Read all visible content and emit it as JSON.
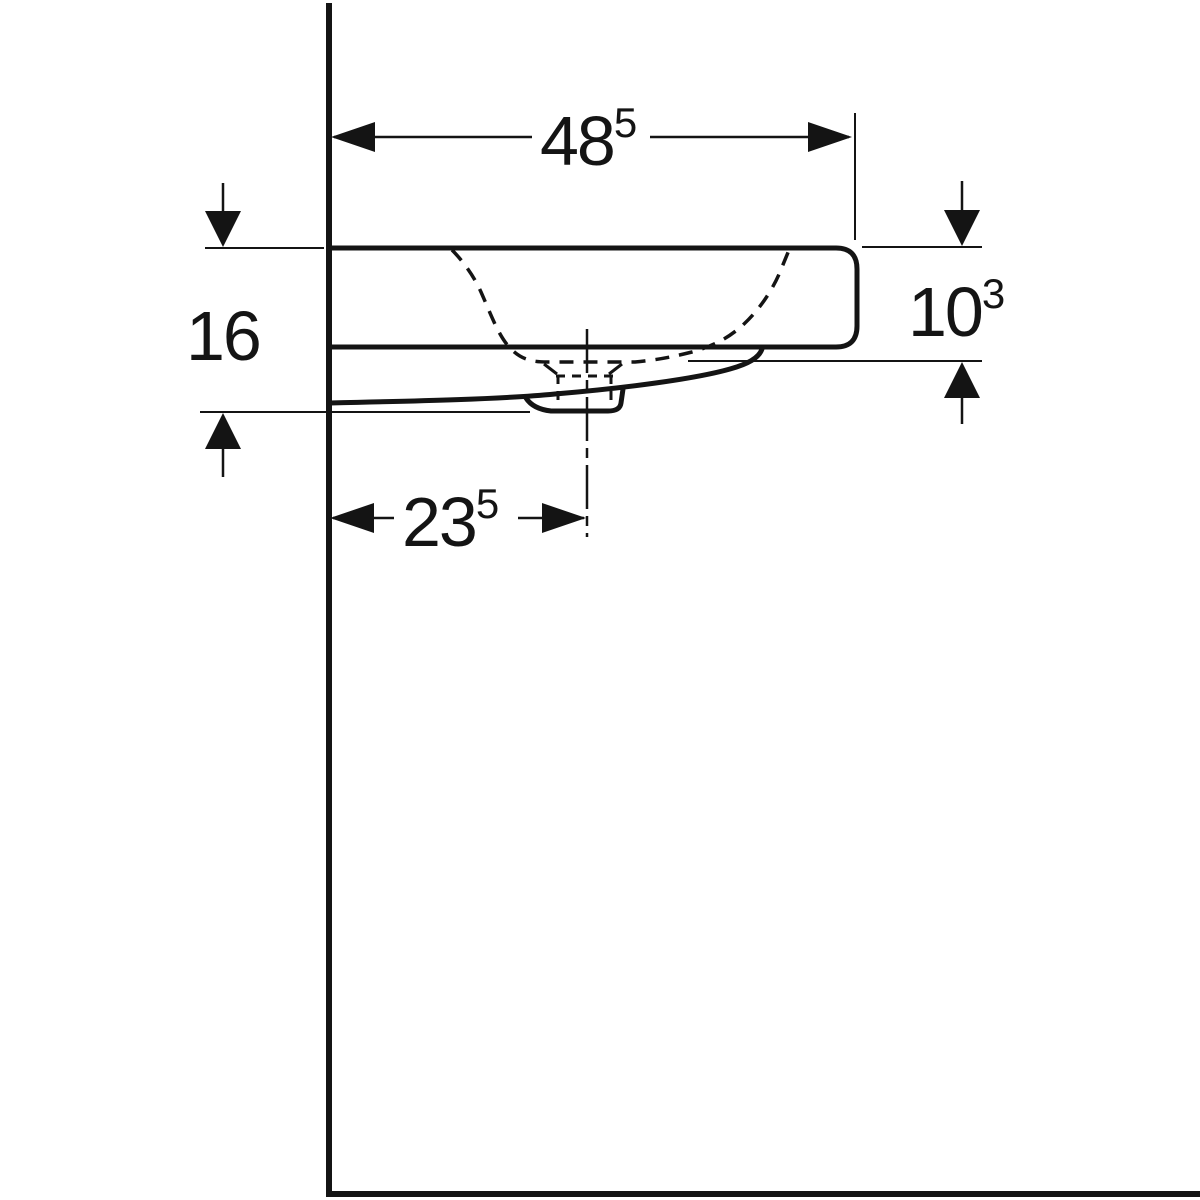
{
  "drawing": {
    "type": "technical-dimension-drawing",
    "subject": "wall-hung washbasin side elevation",
    "colors": {
      "line": "#141414",
      "background": "#ffffff"
    },
    "dimensions": {
      "width_top": {
        "value": "48",
        "sup": "5"
      },
      "height_left": {
        "value": "16",
        "sup": ""
      },
      "height_right": {
        "value": "10",
        "sup": "3"
      },
      "drain_offset": {
        "value": "23",
        "sup": "5"
      }
    }
  }
}
